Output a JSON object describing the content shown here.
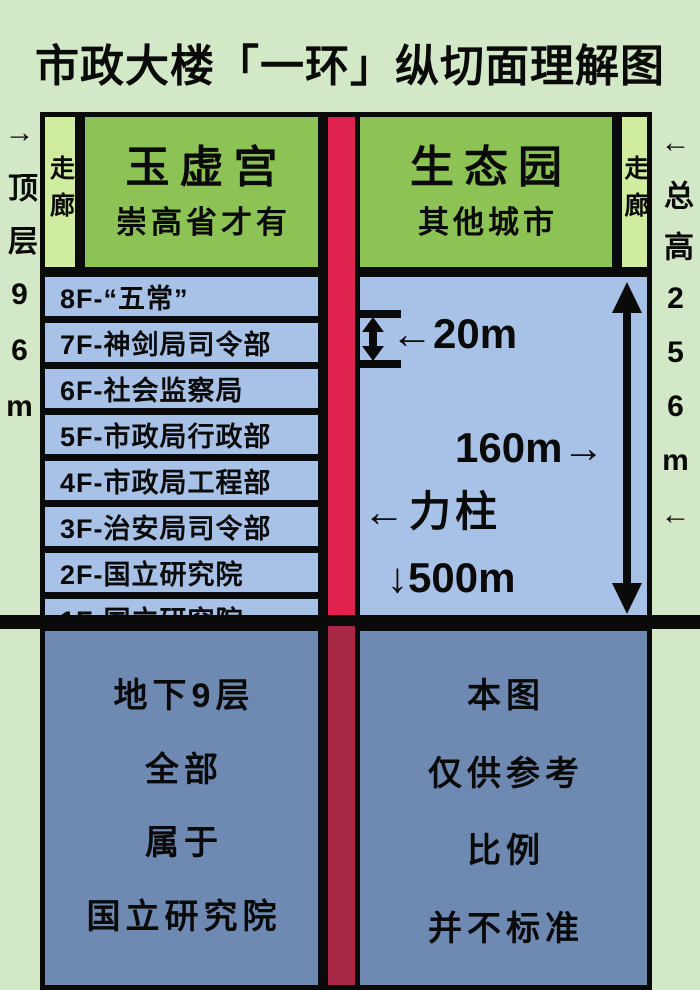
{
  "title": "市政大楼「一环」纵切面理解图",
  "side_labels": {
    "left": "→顶层96m",
    "right": "←总高256m←"
  },
  "left_tower": {
    "corridor": "走廊",
    "hall_name": "玉虚宫",
    "hall_note": "崇高省才有",
    "floors": [
      "8F-“五常”",
      "7F-神剑局司令部",
      "6F-社会监察局",
      "5F-市政局行政部",
      "4F-市政局工程部",
      "3F-治安局司令部",
      "2F-国立研究院",
      "1F-国立研究院"
    ],
    "underground": [
      "地下9层",
      "全部",
      "属于",
      "国立研究院"
    ]
  },
  "right_tower": {
    "corridor": "走廊",
    "hall_name": "生态园",
    "hall_note": "其他城市",
    "annotations": {
      "gap_20m": "←20m",
      "height_160m": "160m→",
      "pillar": "←力柱",
      "depth_500m": "↓500m"
    },
    "underground": [
      "本图",
      "仅供参考",
      "比例",
      "并不标准"
    ]
  },
  "icons": {
    "ibeam": "vertical-span-20m-double-arrow-between-bars",
    "tall_arrow": "vertical-double-headed-arrow-160m"
  },
  "colors": {
    "page-bg": "#d2e8c6",
    "hall-green": "#8dc355",
    "corridor-green": "#cfec9f",
    "floor-blue": "#a8c1e6",
    "under-blue": "#6e89b2",
    "pillar-red": "#e0234e",
    "pillar-dark-red": "#a62844",
    "ink": "#0a0a0a"
  }
}
